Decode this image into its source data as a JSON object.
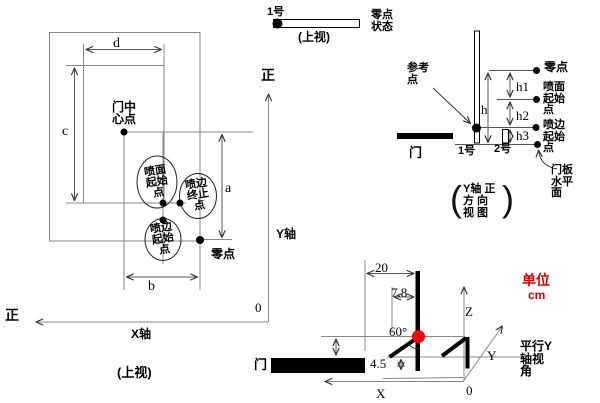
{
  "colors": {
    "accent_red": "#d40000",
    "red_dot": "#ea0a0a",
    "line_gray": "#878787"
  },
  "left_view": {
    "dim_d": "d",
    "dim_c": "c",
    "dim_a": "a",
    "dim_b": "b",
    "door_center": "门中\n心点",
    "spray_face_start": "喷面\n起始\n点",
    "spray_edge_end": "喷边\n终止\n点",
    "spray_edge_start": "喷边\n起始\n点",
    "zero_point": "零点",
    "y_axis": "Y轴",
    "x_axis": "X轴",
    "positive_up": "正",
    "positive_left": "正",
    "origin": "0",
    "view_caption": "(上视)"
  },
  "top_view_strip": {
    "gun_label": "1号",
    "view_caption": "(上视)",
    "zero_status": "零点\n状态"
  },
  "side_view": {
    "reference_point": "参考\n点",
    "zero_point": "零点",
    "h": "h",
    "h1": "h1",
    "h2": "h2",
    "h3": "h3",
    "spray_face_start": "喷面\n起始\n点",
    "spray_edge_start": "喷边\n起始\n点",
    "door": "门",
    "gun1": "1号",
    "gun2": "2号",
    "panel_plane": "门板\n水平\n面",
    "view_caption": "Y轴 正\n方 向\n视 图",
    "paren_open": "(",
    "paren_close": ")"
  },
  "iso_view": {
    "dim_20": "20",
    "dim_7_8": "7.8",
    "dim_4_5": "4.5",
    "angle": "60°",
    "axis_x": "X",
    "axis_y": "Y",
    "axis_z": "Z",
    "origin": "0",
    "door": "门",
    "unit_label": "单位",
    "unit_value": "cm",
    "view_note": "平行Y\n轴视\n角"
  }
}
